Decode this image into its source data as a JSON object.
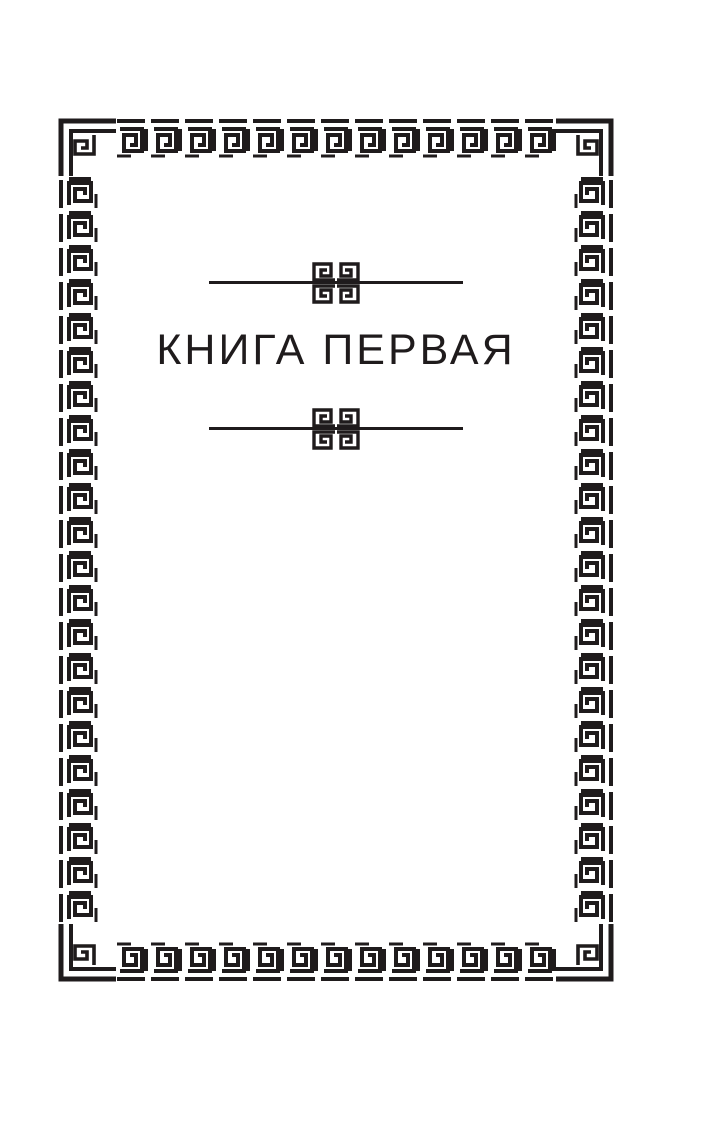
{
  "page": {
    "title": "КНИГА ПЕРВАЯ",
    "background_color": "#ffffff",
    "ink_color": "#1f1b1c"
  },
  "ornaments": {
    "border_icon": "greek-key-meander-border",
    "corner_icon": "greek-key-corner-spiral",
    "divider_icon": "quad-greek-spiral-ornament"
  }
}
